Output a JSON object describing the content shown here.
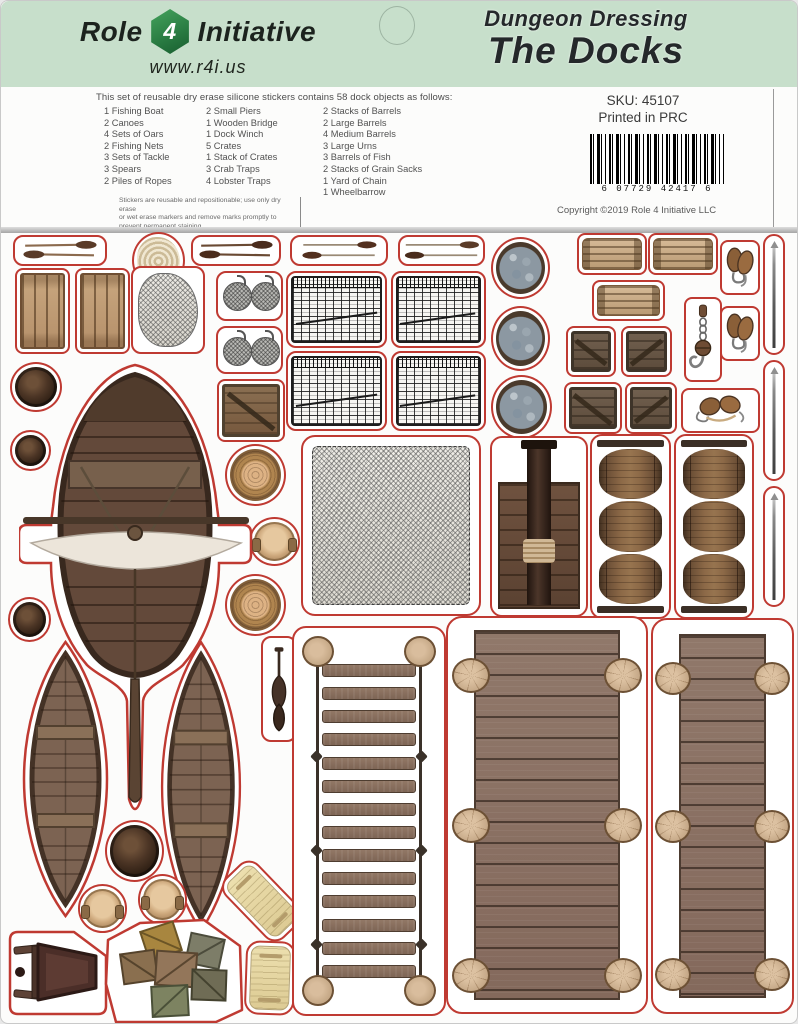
{
  "header": {
    "brand": {
      "word1": "Role",
      "dice_number": "4",
      "word2": "Initiative",
      "website": "www.r4i.us"
    },
    "title_line1": "Dungeon Dressing",
    "title_line2": "The Docks"
  },
  "info": {
    "intro": "This set of reusable dry erase silicone stickers contains 58 dock objects as follows:",
    "columns": [
      [
        "1 Fishing Boat",
        "2 Canoes",
        "4 Sets of Oars",
        "2 Fishing Nets",
        "3 Sets of Tackle",
        "3 Spears",
        "2 Piles of Ropes"
      ],
      [
        "2 Small Piers",
        "1 Wooden Bridge",
        "1 Dock Winch",
        "5 Crates",
        "1 Stack of Crates",
        "3 Crab Traps",
        "4 Lobster Traps"
      ],
      [
        "2 Stacks of Barrels",
        "2 Large Barrels",
        "4 Medium Barrels",
        "3 Large Urns",
        "3 Barrels of Fish",
        "2 Stacks of Grain Sacks",
        "1 Yard of Chain",
        "1 Wheelbarrow"
      ]
    ],
    "fine_print": [
      "Stickers are reusable and repositionable; use only dry erase",
      "or wet erase markers and remove marks promptly to",
      "prevent permanent staining."
    ],
    "sku": "SKU: 45107",
    "printed": "Printed in PRC",
    "barcode_digits": "6 07729 42417 6",
    "copyright": "Copyright ©2019    Role 4 Initiative LLC"
  },
  "colors": {
    "outline_red": "#bf3a32",
    "header_green": "#c7dfcb"
  }
}
